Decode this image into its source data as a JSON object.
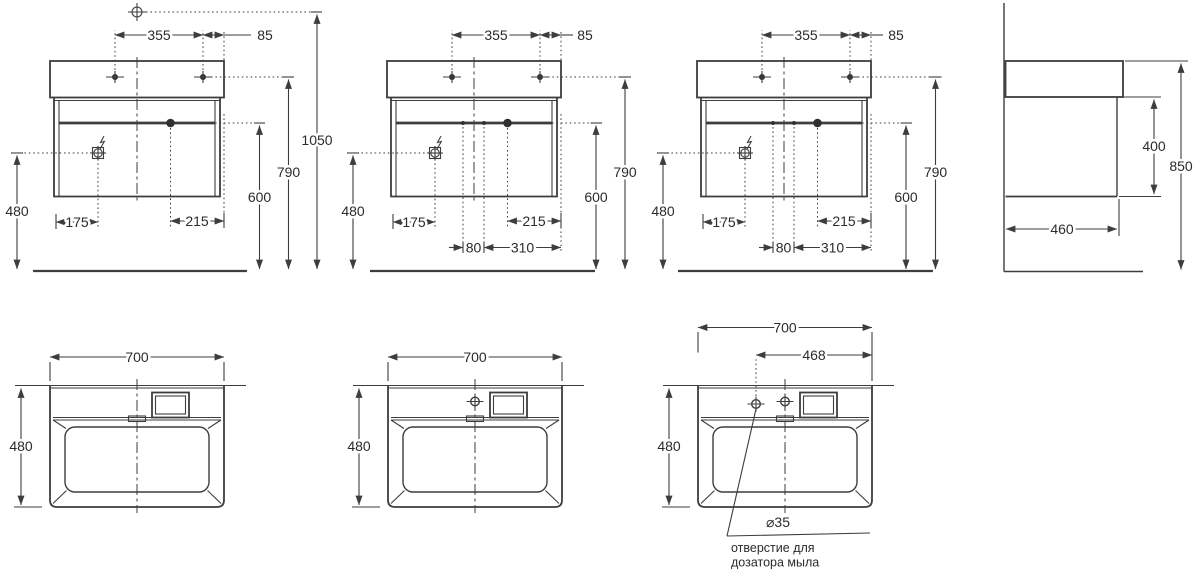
{
  "colors": {
    "background": "#ffffff",
    "lines": "#3d3d3d",
    "text": "#2b2b2b"
  },
  "symbols": {
    "datum_point": "circle-crosshair",
    "faucet_hole_front": "filled-dot-crosshair",
    "extra_hole": "small-filled-dot",
    "drain_knob": "large-filled-dot",
    "power_outlet": "square-circle-lightning",
    "tap_hole_top": "open-circle-crosshair",
    "soap_dispenser_hole": "open-circle-crosshair"
  },
  "front_view_1": {
    "faucet_span": "355",
    "faucet_to_edge": "85",
    "datum_height": "1050",
    "faucet_height": "790",
    "drawer_line_height": "600",
    "outlet_height": "480",
    "outlet_offset": "175",
    "drain_offset": "215"
  },
  "front_view_2": {
    "faucet_span": "355",
    "faucet_to_edge": "85",
    "faucet_height": "790",
    "drawer_line_height": "600",
    "outlet_height": "480",
    "outlet_offset": "175",
    "drain_offset": "215",
    "hole_span": "80",
    "hole_to_edge": "310"
  },
  "front_view_3": {
    "faucet_span": "355",
    "faucet_to_edge": "85",
    "faucet_height": "790",
    "drawer_line_height": "600",
    "outlet_height": "480",
    "outlet_offset": "175",
    "drain_offset": "215",
    "hole_span": "80",
    "hole_to_edge": "310"
  },
  "side_view": {
    "cabinet_height": "400",
    "total_height": "850",
    "depth": "460"
  },
  "top_view_1": {
    "width": "700",
    "depth": "480"
  },
  "top_view_2": {
    "width": "700",
    "depth": "480"
  },
  "top_view_3": {
    "width": "700",
    "soap_hole_to_edge": "468",
    "depth": "480",
    "soap_hole_diameter": "⌀35",
    "soap_note_line1": "отверстие для",
    "soap_note_line2": "дозатора мыла"
  }
}
